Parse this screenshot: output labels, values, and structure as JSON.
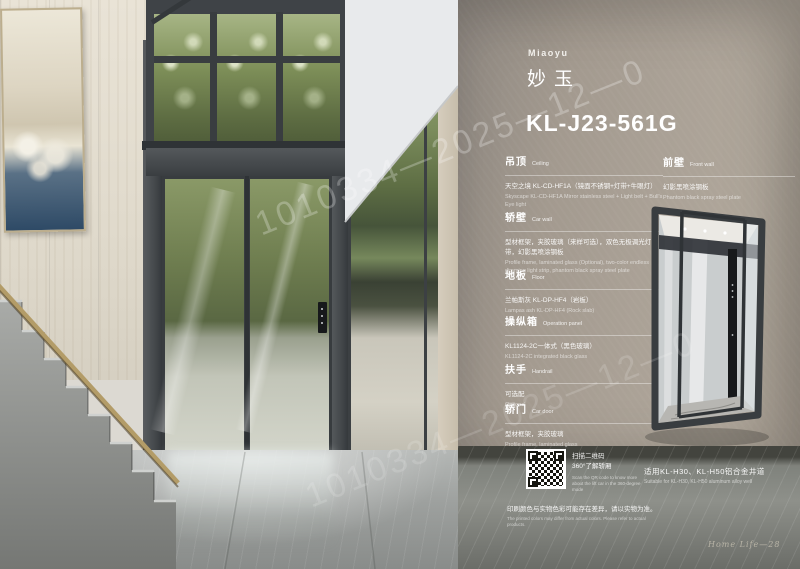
{
  "watermark": {
    "text": "1010334—2025—12—0"
  },
  "header": {
    "brand_en": "Miaoyu",
    "brand_cn": "妙玉",
    "model": "KL-J23-561G"
  },
  "sections": [
    {
      "title_cn": "吊顶",
      "title_en": "Ceiling",
      "body_cn": "天空之境 KL-CD-HF1A（镜面不锈钢+灯带+牛眼灯）",
      "body_en": "Skyscape KL-CD-HF1A Mirror stainless steel + Light belt + Bull's Eye light"
    },
    {
      "title_cn": "轿壁",
      "title_en": "Car wall",
      "body_cn": "型材框架，夹胶玻璃（来样可选），双色无极调光灯带，幻影黑喷涂钢板",
      "body_en": "Profile frame, laminated glass (Optional), two-color endless dimming light strip, phantom black spray steel plate"
    },
    {
      "title_cn": "地板",
      "title_en": "Floor",
      "body_cn": "兰帕斯灰 KL-DP-HF4（岩板）",
      "body_en": "Lampas ash KL-DP-HF4 (Rock slab)"
    },
    {
      "title_cn": "操纵箱",
      "title_en": "Operation panel",
      "body_cn": "KL1124-2C一体式（黑色玻璃）",
      "body_en": "KL1124-2C integrated black glass"
    },
    {
      "title_cn": "扶手",
      "title_en": "Handrail",
      "body_cn": "可选配",
      "body_en": "Optional"
    },
    {
      "title_cn": "轿门",
      "title_en": "Car door",
      "body_cn": "型材框架，夹胶玻璃",
      "body_en": "Profile frame, laminated glass"
    },
    {
      "title_cn": "前壁",
      "title_en": "Front wall",
      "body_cn": "幻影黑喷涂钢板",
      "body_en": "Phantom black spray steel plate"
    }
  ],
  "qr": {
    "caption_cn_1": "扫描二维码",
    "caption_cn_2": "360°了解轿厢",
    "caption_en": "Scan the QR code to know more about the lift car in the 360-degree mode"
  },
  "suitable": {
    "cn": "适用KL-H30、KL-H50铝合金井道",
    "en": "Suitable for KL-H30, KL-H50 aluminum alloy well"
  },
  "disclaimer": {
    "cn": "印刷颜色与实物色彩可能存在差异，请以实物为准。",
    "en": "The printed colors may differ from actual colors. Please refer to actual products."
  },
  "footer": {
    "page_label": "Home Life—28"
  },
  "colors": {
    "spec_wall": "#a59c91",
    "elevator_frame": "#43474a",
    "text": "#ffffff",
    "brass_rail": "#b39c68"
  }
}
